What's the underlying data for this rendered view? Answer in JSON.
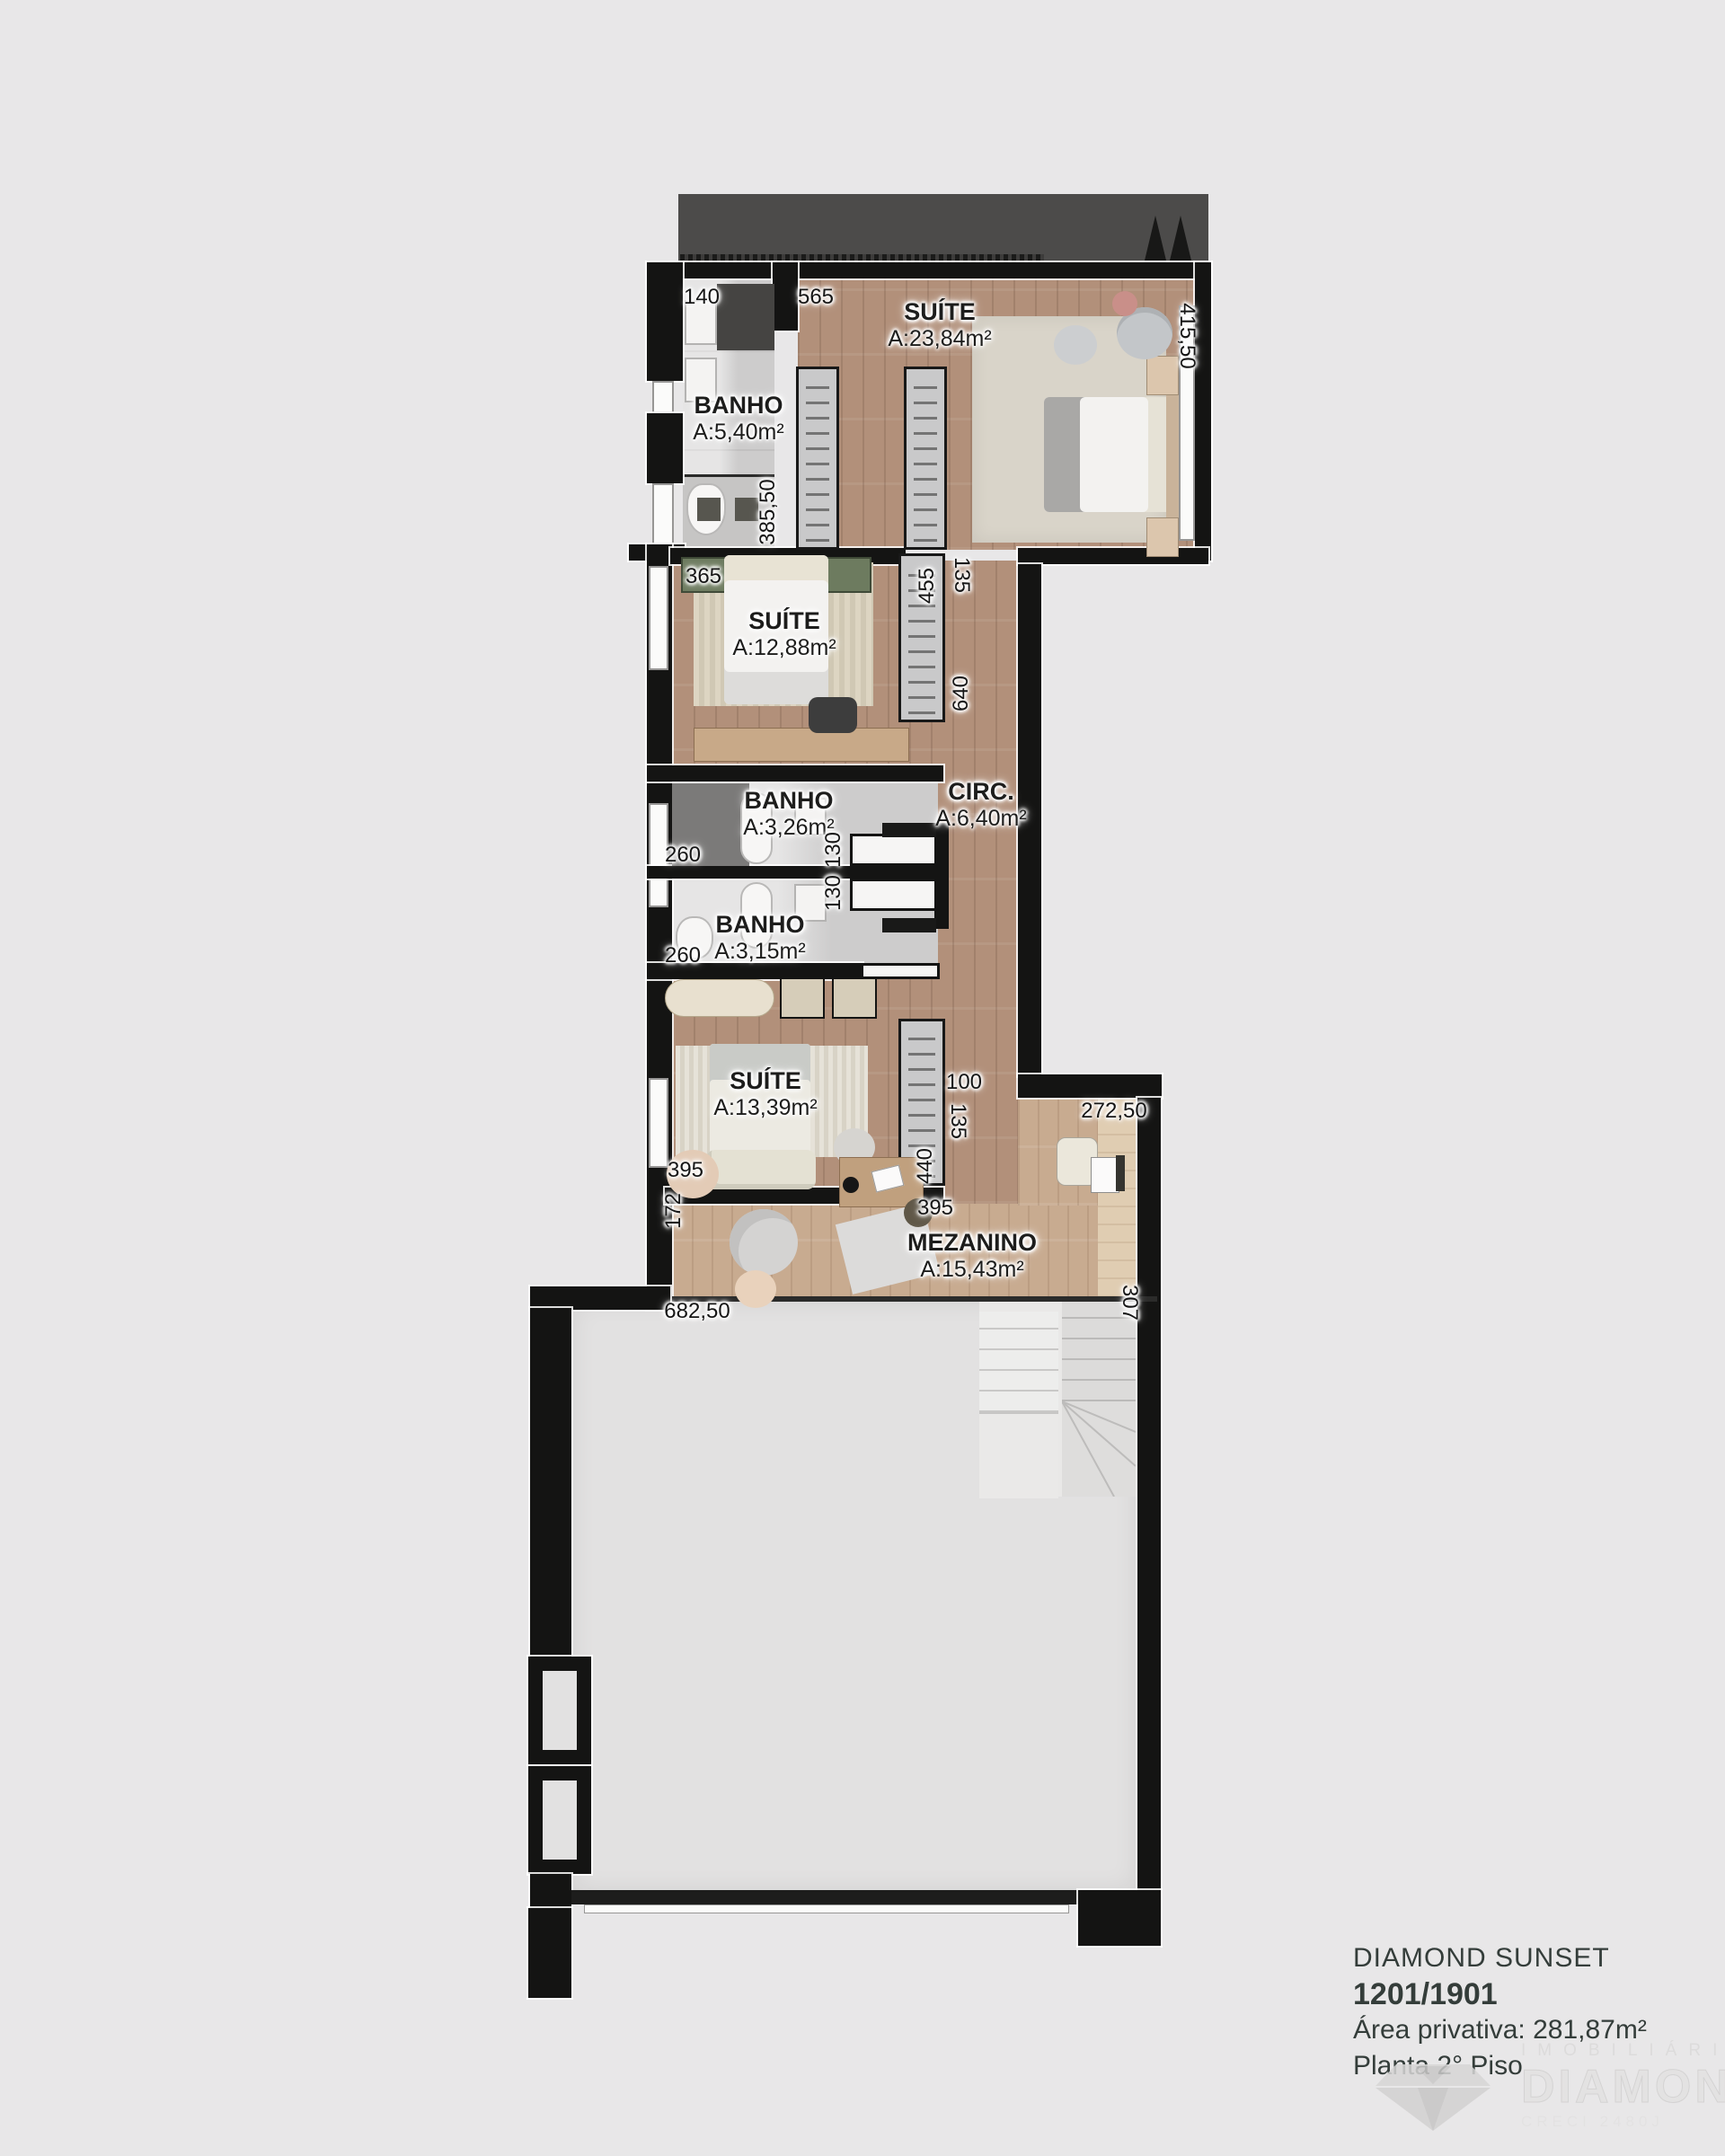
{
  "colors": {
    "background": "#e8e7e8",
    "wall": "#141413",
    "wood_floor": "#b2907a",
    "mezzanine_wood": "#c8ab90",
    "bath_tile": "#d8d7d7",
    "void_floor": "#e2e1e1",
    "terrace_roof": "#4c4b4a",
    "accent_green": "#6d7b5f",
    "label_text": "#1d1d1c",
    "title_text": "#343d3a",
    "watermark": "#dddcdc"
  },
  "rooms": [
    {
      "id": "suite-master",
      "name": "SUÍTE",
      "area": "A:23,84m²"
    },
    {
      "id": "banho-master",
      "name": "BANHO",
      "area": "A:5,40m²"
    },
    {
      "id": "suite-2",
      "name": "SUÍTE",
      "area": "A:12,88m²"
    },
    {
      "id": "circulacao",
      "name": "CIRC.",
      "area": "A:6,40m²"
    },
    {
      "id": "banho-2",
      "name": "BANHO",
      "area": "A:3,26m²"
    },
    {
      "id": "banho-3",
      "name": "BANHO",
      "area": "A:3,15m²"
    },
    {
      "id": "suite-3",
      "name": "SUÍTE",
      "area": "A:13,39m²"
    },
    {
      "id": "mezanino",
      "name": "MEZANINO",
      "area": "A:15,43m²"
    }
  ],
  "dimensions": {
    "d140": "140",
    "d565": "565",
    "d41550": "415,50",
    "d38550": "385,50",
    "d365": "365",
    "d455": "455",
    "d135a": "135",
    "d640": "640",
    "d260a": "260",
    "d130a": "130",
    "d130b": "130",
    "d260b": "260",
    "d100": "100",
    "d135b": "135",
    "d440": "440",
    "d395a": "395",
    "d395b": "395",
    "d172": "172",
    "d68250": "682,50",
    "d27250": "272,50",
    "d307": "307"
  },
  "title_block": {
    "project": "DIAMOND SUNSET",
    "unit": "1201/1901",
    "area_line": "Área privativa: 281,87m²",
    "floor_line": "Planta 2° Piso"
  },
  "watermark": {
    "line1": "IMOBILIÁRIA",
    "line2": "DIAMOND",
    "line3": "CRECI 2480J"
  }
}
